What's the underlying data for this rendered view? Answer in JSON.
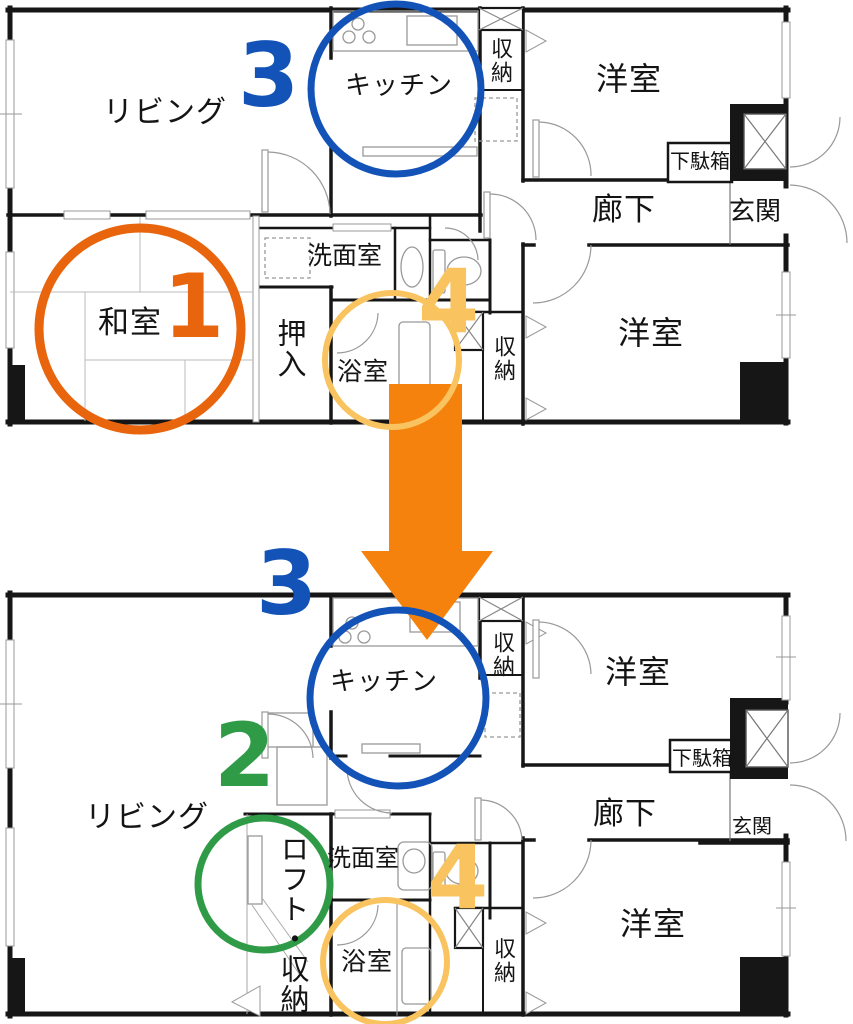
{
  "colors": {
    "step1_orange": "#E8650D",
    "step2_green": "#2F9B47",
    "step3_blue": "#1353B7",
    "step4_yellow": "#F9C35F",
    "arrow_orange": "#F5820D",
    "walls": "#161616"
  },
  "steps": {
    "one": "1",
    "two": "2",
    "three": "3",
    "four": "4"
  },
  "before": {
    "living": "リビング",
    "kitchen": "キッチン",
    "storage_top": "収納",
    "western_top": "洋室",
    "shoe_cabinet": "下駄箱",
    "hallway": "廊下",
    "entrance": "玄関",
    "japanese_room": "和室",
    "closet": "押入",
    "washroom": "洗面室",
    "bathroom": "浴室",
    "storage_bottom": "収納",
    "western_bottom": "洋室"
  },
  "after": {
    "kitchen": "キッチン",
    "storage_top": "収納",
    "western_top": "洋室",
    "shoe_cabinet": "下駄箱",
    "hallway": "廊下",
    "entrance": "玄関",
    "living": "リビング",
    "loft_storage": "ロフト・収納",
    "washroom": "洗面室",
    "bathroom": "浴室",
    "storage_bottom": "収納",
    "western_bottom": "洋室"
  }
}
